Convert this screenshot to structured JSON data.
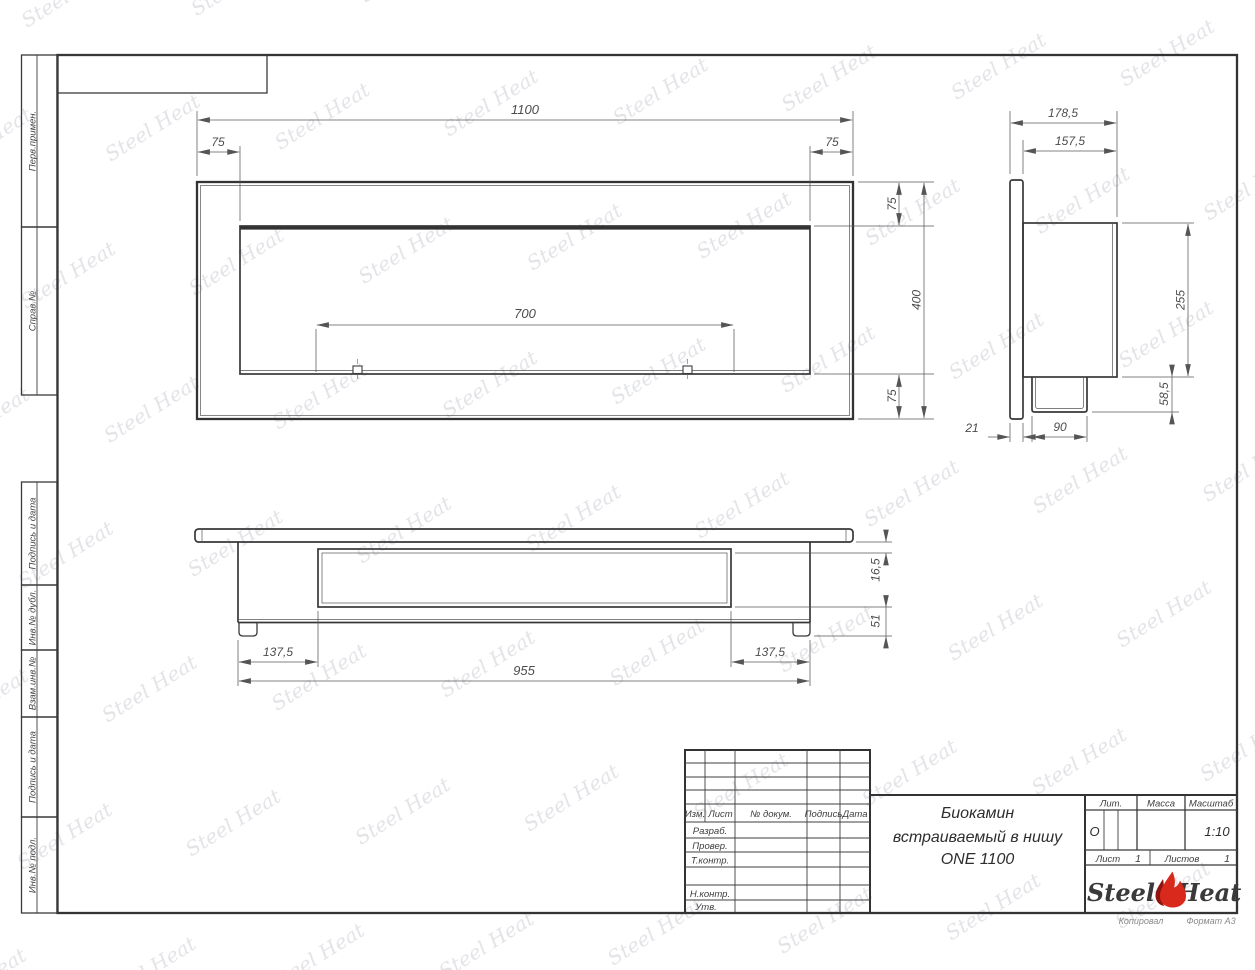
{
  "watermark": {
    "text": "Steel Heat"
  },
  "margin_labels": [
    "Перв.примен.",
    "Справ.№",
    "Подпись и дата",
    "Инв.№ дубл.",
    "Взам.инв.№",
    "Подпись и дата",
    "Инв.№ подл."
  ],
  "dims": {
    "front": {
      "width": "1100",
      "inset_left": "75",
      "inset_right": "75",
      "slot": "700",
      "top_offset": "75",
      "height": "400",
      "bottom_offset": "75"
    },
    "side": {
      "depth_total": "178,5",
      "depth_body": "157,5",
      "body_height": "255",
      "box_height": "58,5",
      "flange_thk": "21",
      "box_width": "90"
    },
    "plan": {
      "plate_gap": "16,5",
      "base_height": "51",
      "offset_left": "137,5",
      "length": "955",
      "offset_right": "137,5"
    }
  },
  "stamp": {
    "cols": {
      "izm": "Изм.",
      "list": "Лист",
      "doc": "№ докум.",
      "sign": "Подпись",
      "date": "Дата"
    },
    "rows": {
      "razrab": "Разраб.",
      "prover": "Провер.",
      "tkontr": "Т.контр.",
      "nkontr": "Н.контр.",
      "utv": "Утв."
    },
    "title_line1": "Биокамин",
    "title_line2": "встраиваемый в нишу",
    "title_line3": "ONE 1100",
    "lit_label": "Лит.",
    "lit_value": "О",
    "massa_label": "Масса",
    "scale_label": "Масштаб",
    "scale_value": "1:10",
    "sheet_label": "Лист",
    "sheet_value": "1",
    "sheets_label": "Листов",
    "sheets_value": "1",
    "logo_left": "Steel",
    "logo_right": "Heat",
    "copied": "Копировал",
    "format": "Формат А3"
  }
}
